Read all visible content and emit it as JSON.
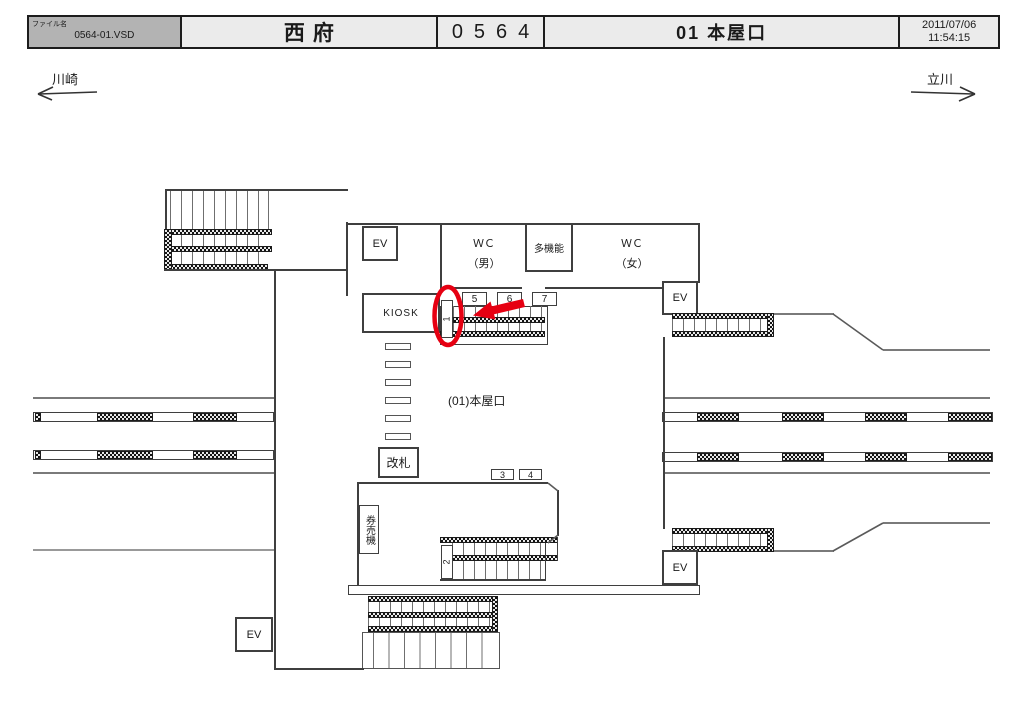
{
  "header": {
    "file_label": "ファイル名",
    "file_name": "0564-01.VSD",
    "station_name": "西府",
    "station_code": "0564",
    "title": "01 本屋口",
    "date": "2011/07/06",
    "time": "11:54:15"
  },
  "directions": {
    "left_label": "川崎",
    "right_label": "立川"
  },
  "map": {
    "labels": {
      "ev": "EV",
      "kiosk": "KIOSK",
      "wc": "ＷＣ",
      "wc_men": "（男）",
      "wc_women": "（女）",
      "multifunction": "多機能",
      "ticket_gate": "改札",
      "ticket_machines": "券売機",
      "area": "(01)本屋口"
    },
    "positions": {
      "p1": "1",
      "p2": "2",
      "p3": "3",
      "p4": "4",
      "p5": "5",
      "p6": "6",
      "p7": "7"
    },
    "colors": {
      "annotation_red": "#e60012"
    }
  }
}
